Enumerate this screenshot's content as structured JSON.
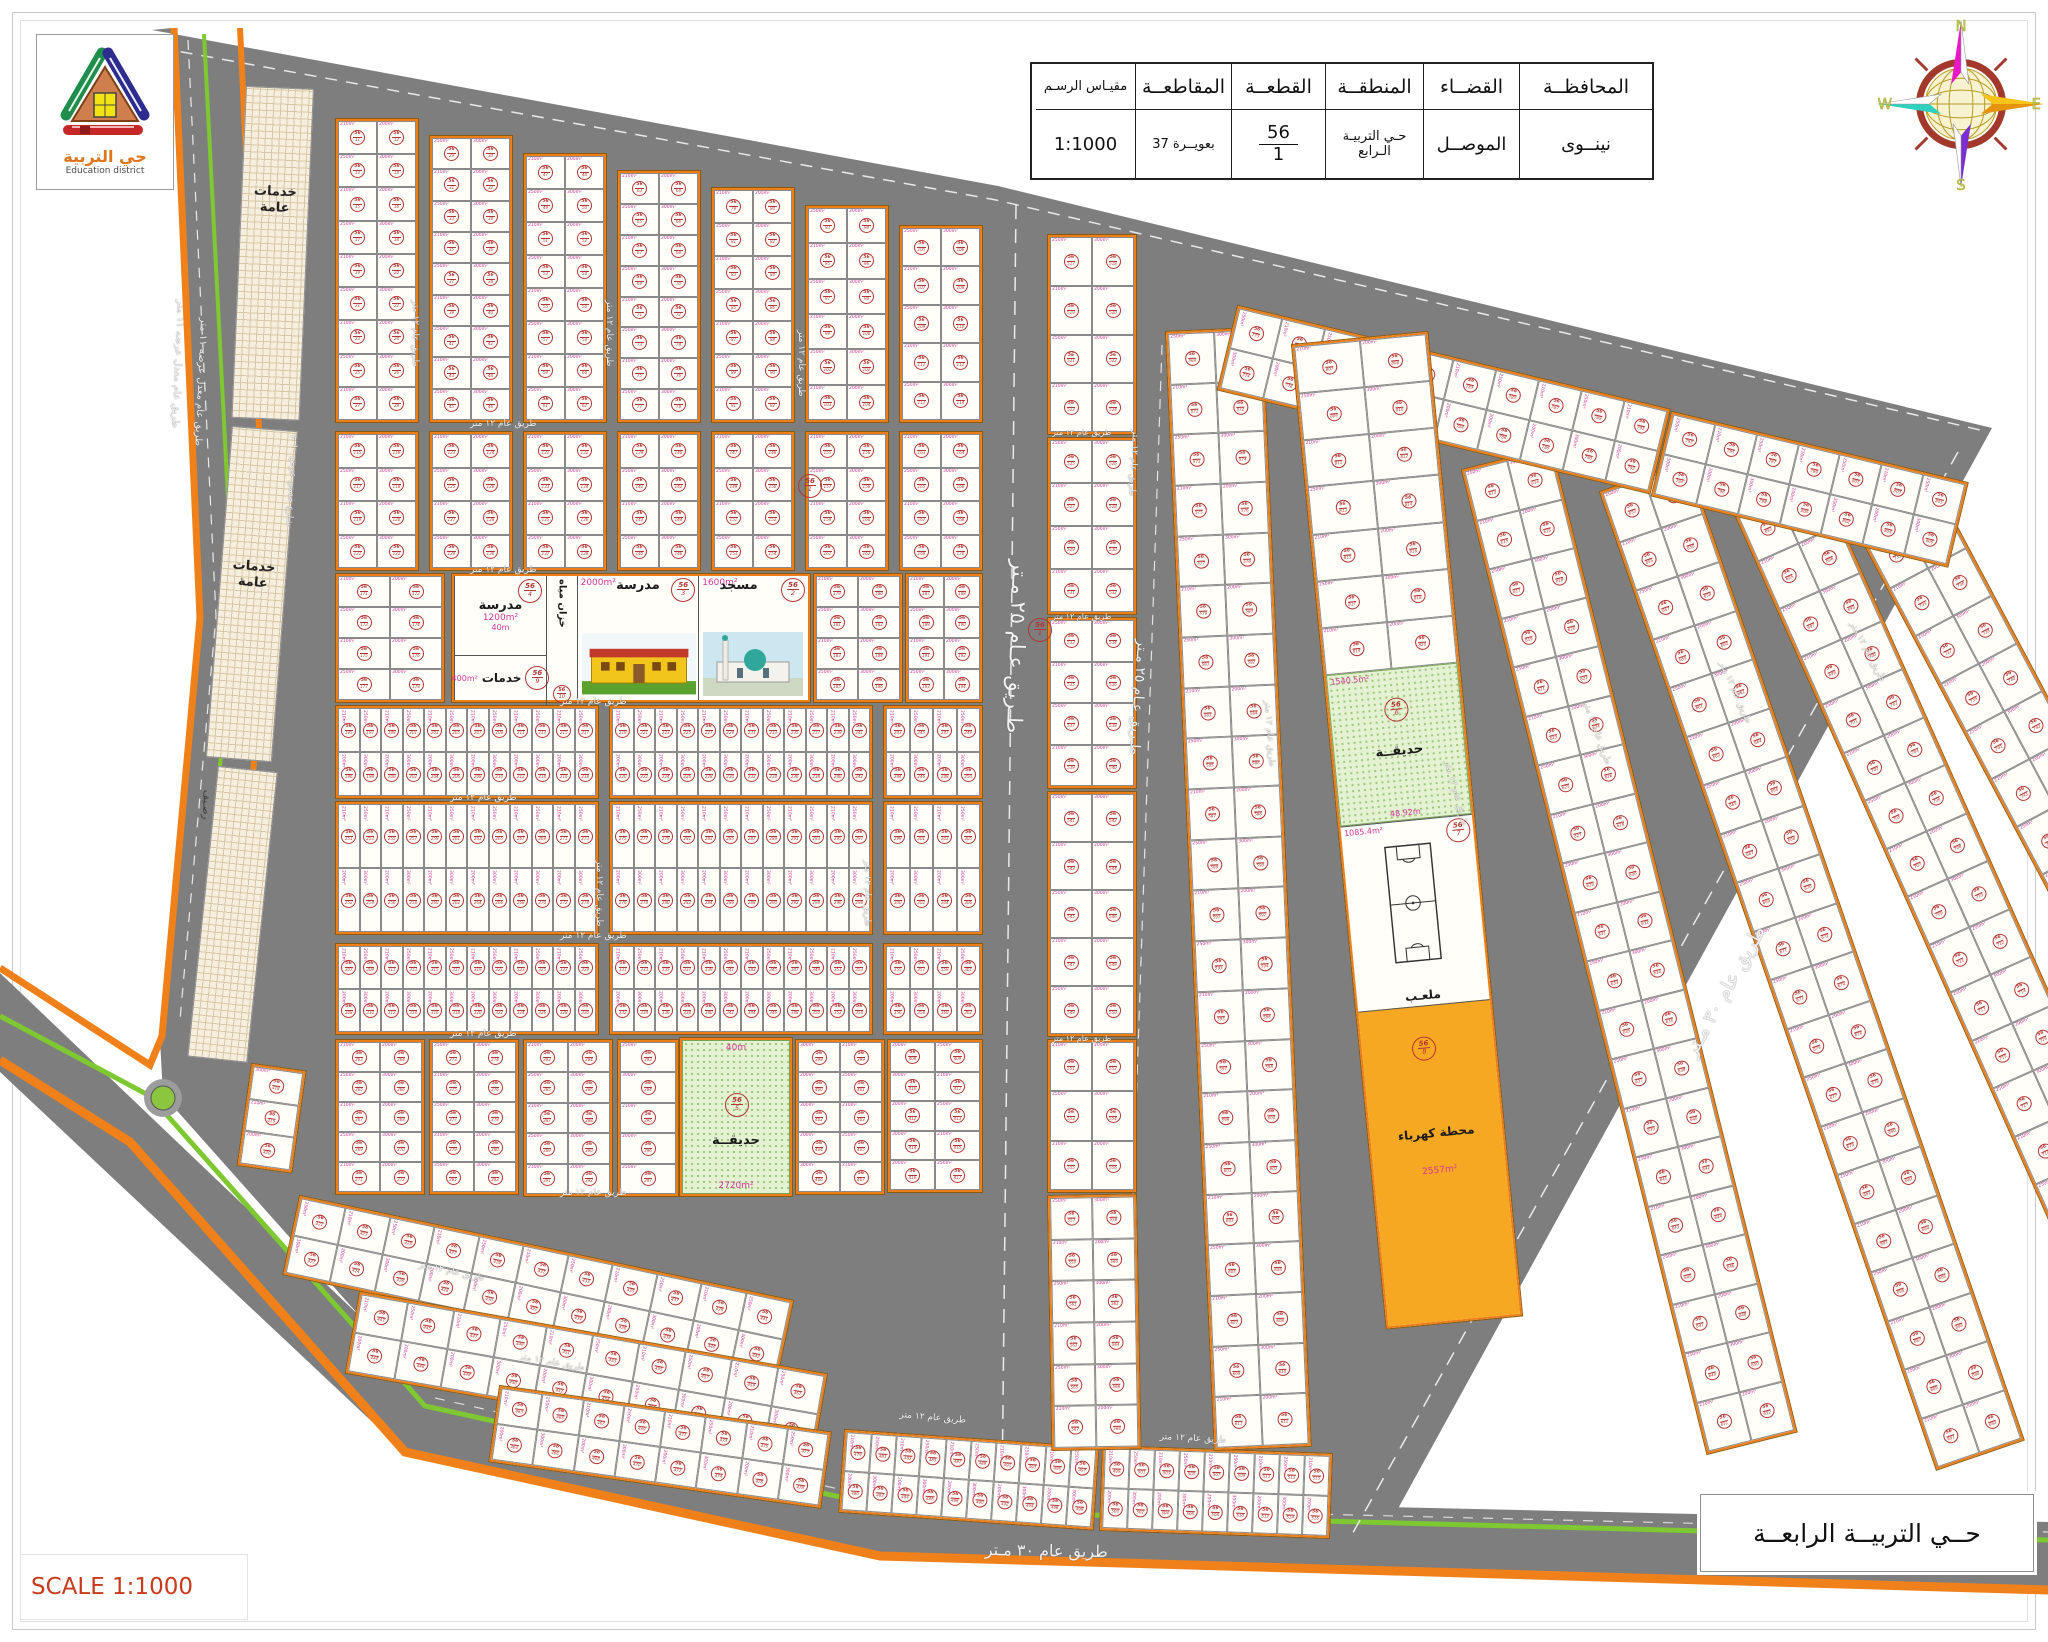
{
  "title_block": {
    "cols": [
      {
        "label": "المحافظــة",
        "value": "نينــوى"
      },
      {
        "label": "القضــاء",
        "value": "الموصــل"
      },
      {
        "label": "المنطقــة",
        "value": "حـي التربيـة الـرابع"
      },
      {
        "label": "القطعــة",
        "num": "56",
        "den": "1"
      },
      {
        "label": "المقاطعــة",
        "value": "37 بعويــرة"
      },
      {
        "label": "مقيـاس الرسـم",
        "value": "1:1000"
      }
    ]
  },
  "logo": {
    "title": "حي التربية",
    "subtitle": "Education district"
  },
  "compass": {
    "n": "N",
    "e": "E",
    "s": "S",
    "w": "W"
  },
  "footer": {
    "scale": "SCALE 1:1000",
    "district": "حــي التربيــة الرابعــة"
  },
  "roads": {
    "r25": "طـريق عـام ٢٥ مـتر",
    "r30": "طريق عام ٣٠ مـتر",
    "r12": "طريق عام ١٢ متر",
    "r11": "طريق عام معدل عرضه ١١ متر",
    "service": "شارع خدمي عرض ١٠ م"
  },
  "landmarks": {
    "school_small": {
      "label": "مدرسة",
      "area": "1200m²",
      "stamp_no": "4",
      "dim": "40m"
    },
    "services": {
      "label": "خدمات",
      "area": "400m²",
      "stamp_no": "9"
    },
    "water_tank": {
      "label": "خزان مياه",
      "stamp_no": "10"
    },
    "school_big": {
      "label": "مدرسة",
      "area": "2000m²",
      "stamp_no": "3",
      "dim": "50m"
    },
    "mosque": {
      "label": "مسجد",
      "area": "1600m²",
      "stamp_no": "2",
      "dim": "40m"
    },
    "park_center": {
      "label": "حديقــة",
      "area": "2720m²",
      "dim": "40m",
      "stamp_no": "5"
    },
    "park_east": {
      "label": "حديقــة",
      "area": "1540.5m²",
      "dim": "48.92m",
      "stamp_no": "6"
    },
    "stadium": {
      "label": "ملعـب",
      "area": "1085.4m²",
      "stamp_no": "7"
    },
    "power": {
      "label": "محطة كهرباء",
      "area": "2557m²",
      "stamp_no": "8"
    },
    "public_services": "خدمات عامة",
    "sidewalk": "رصـيف"
  },
  "plots": {
    "prefix": "56",
    "parcel_no": "1",
    "areas": [
      "200m²",
      "250m²",
      "300m²",
      "210m²"
    ]
  }
}
